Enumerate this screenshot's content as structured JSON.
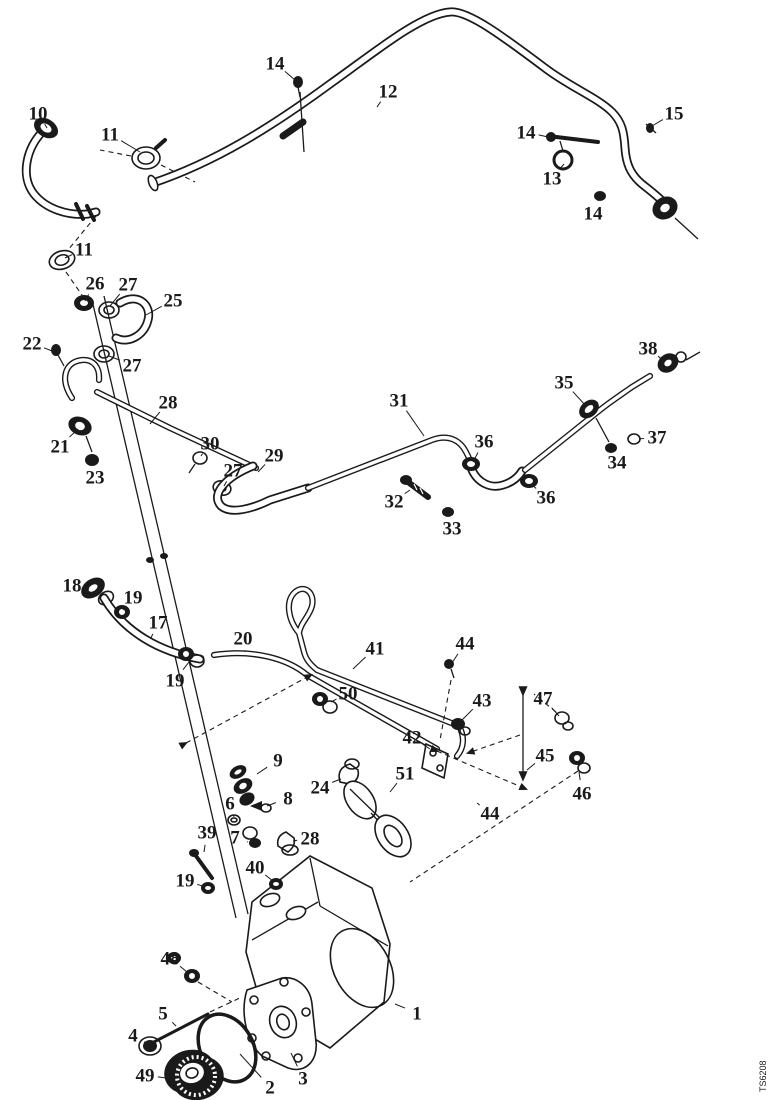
{
  "figure": {
    "type": "exploded-parts-diagram",
    "doc_code": "TS6208",
    "background_color": "#ffffff",
    "ink_color": "#1a1a1a"
  },
  "callouts": [
    {
      "n": "10",
      "x": 38,
      "y": 113,
      "tx": 47,
      "ty": 128
    },
    {
      "n": "11",
      "x": 110,
      "y": 134,
      "tx": 140,
      "ty": 152
    },
    {
      "n": "14",
      "x": 275,
      "y": 63,
      "tx": 295,
      "ty": 80
    },
    {
      "n": "12",
      "x": 388,
      "y": 91,
      "tx": 377,
      "ty": 107
    },
    {
      "n": "14",
      "x": 526,
      "y": 132,
      "tx": 548,
      "ty": 137
    },
    {
      "n": "13",
      "x": 552,
      "y": 178,
      "tx": 564,
      "ty": 164
    },
    {
      "n": "14",
      "x": 593,
      "y": 213,
      "tx": 599,
      "ty": 198
    },
    {
      "n": "15",
      "x": 674,
      "y": 113,
      "tx": 652,
      "ty": 126
    },
    {
      "n": "11",
      "x": 84,
      "y": 249,
      "tx": 65,
      "ty": 258
    },
    {
      "n": "26",
      "x": 95,
      "y": 283,
      "tx": 85,
      "ty": 301
    },
    {
      "n": "27",
      "x": 128,
      "y": 284,
      "tx": 110,
      "ty": 306
    },
    {
      "n": "25",
      "x": 173,
      "y": 300,
      "tx": 146,
      "ty": 315
    },
    {
      "n": "22",
      "x": 32,
      "y": 343,
      "tx": 52,
      "ty": 351
    },
    {
      "n": "27",
      "x": 132,
      "y": 365,
      "tx": 109,
      "ty": 356
    },
    {
      "n": "28",
      "x": 168,
      "y": 402,
      "tx": 150,
      "ty": 424
    },
    {
      "n": "21",
      "x": 60,
      "y": 446,
      "tx": 78,
      "ty": 429
    },
    {
      "n": "23",
      "x": 95,
      "y": 477,
      "tx": 92,
      "ty": 463
    },
    {
      "n": "30",
      "x": 210,
      "y": 443,
      "tx": 201,
      "ty": 456
    },
    {
      "n": "27",
      "x": 233,
      "y": 470,
      "tx": 224,
      "ty": 486
    },
    {
      "n": "29",
      "x": 274,
      "y": 455,
      "tx": 258,
      "ty": 472
    },
    {
      "n": "31",
      "x": 399,
      "y": 400,
      "tx": 424,
      "ty": 436
    },
    {
      "n": "32",
      "x": 394,
      "y": 501,
      "tx": 410,
      "ty": 490
    },
    {
      "n": "33",
      "x": 452,
      "y": 528,
      "tx": 448,
      "ty": 514
    },
    {
      "n": "36",
      "x": 484,
      "y": 441,
      "tx": 473,
      "ty": 462
    },
    {
      "n": "36",
      "x": 546,
      "y": 497,
      "tx": 531,
      "ty": 484
    },
    {
      "n": "35",
      "x": 564,
      "y": 382,
      "tx": 586,
      "ty": 406
    },
    {
      "n": "38",
      "x": 648,
      "y": 348,
      "tx": 664,
      "ty": 361
    },
    {
      "n": "37",
      "x": 657,
      "y": 437,
      "tx": 639,
      "ty": 439
    },
    {
      "n": "34",
      "x": 617,
      "y": 462,
      "tx": 612,
      "ty": 451
    },
    {
      "n": "18",
      "x": 72,
      "y": 585,
      "tx": 89,
      "ty": 589
    },
    {
      "n": "19",
      "x": 133,
      "y": 597,
      "tx": 123,
      "ty": 610
    },
    {
      "n": "17",
      "x": 158,
      "y": 622,
      "tx": 151,
      "ty": 638
    },
    {
      "n": "20",
      "x": 243,
      "y": 638,
      "tx": 245,
      "ty": 652
    },
    {
      "n": "41",
      "x": 375,
      "y": 648,
      "tx": 353,
      "ty": 669
    },
    {
      "n": "44",
      "x": 465,
      "y": 643,
      "tx": 452,
      "ty": 663
    },
    {
      "n": "19",
      "x": 175,
      "y": 680,
      "tx": 189,
      "ty": 662
    },
    {
      "n": "50",
      "x": 348,
      "y": 693,
      "tx": 331,
      "ty": 702
    },
    {
      "n": "43",
      "x": 482,
      "y": 700,
      "tx": 461,
      "ty": 721
    },
    {
      "n": "47",
      "x": 543,
      "y": 698,
      "tx": 559,
      "ty": 716
    },
    {
      "n": "42",
      "x": 412,
      "y": 737,
      "tx": 430,
      "ty": 749
    },
    {
      "n": "45",
      "x": 545,
      "y": 755,
      "tx": 527,
      "ty": 770
    },
    {
      "n": "51",
      "x": 405,
      "y": 773,
      "tx": 390,
      "ty": 792
    },
    {
      "n": "46",
      "x": 582,
      "y": 793,
      "tx": 579,
      "ty": 772
    },
    {
      "n": "44",
      "x": 490,
      "y": 813,
      "tx": 477,
      "ty": 803
    },
    {
      "n": "24",
      "x": 320,
      "y": 787,
      "tx": 341,
      "ty": 779
    },
    {
      "n": "9",
      "x": 278,
      "y": 760,
      "tx": 257,
      "ty": 774
    },
    {
      "n": "8",
      "x": 288,
      "y": 798,
      "tx": 267,
      "ty": 806
    },
    {
      "n": "6",
      "x": 230,
      "y": 803,
      "tx": 234,
      "ty": 817
    },
    {
      "n": "39",
      "x": 207,
      "y": 832,
      "tx": 204,
      "ty": 852
    },
    {
      "n": "7",
      "x": 235,
      "y": 837,
      "tx": 248,
      "ty": 842
    },
    {
      "n": "28",
      "x": 310,
      "y": 838,
      "tx": 293,
      "ty": 841
    },
    {
      "n": "40",
      "x": 255,
      "y": 867,
      "tx": 273,
      "ty": 881
    },
    {
      "n": "19",
      "x": 185,
      "y": 880,
      "tx": 205,
      "ty": 887
    },
    {
      "n": "48",
      "x": 170,
      "y": 958,
      "tx": 187,
      "ty": 972
    },
    {
      "n": "5",
      "x": 163,
      "y": 1013,
      "tx": 176,
      "ty": 1026
    },
    {
      "n": "4",
      "x": 133,
      "y": 1035,
      "tx": 146,
      "ty": 1043
    },
    {
      "n": "49",
      "x": 145,
      "y": 1075,
      "tx": 166,
      "ty": 1078
    },
    {
      "n": "2",
      "x": 270,
      "y": 1087,
      "tx": 240,
      "ty": 1054
    },
    {
      "n": "3",
      "x": 303,
      "y": 1078,
      "tx": 291,
      "ty": 1053
    },
    {
      "n": "1",
      "x": 417,
      "y": 1013,
      "tx": 395,
      "ty": 1004
    }
  ]
}
